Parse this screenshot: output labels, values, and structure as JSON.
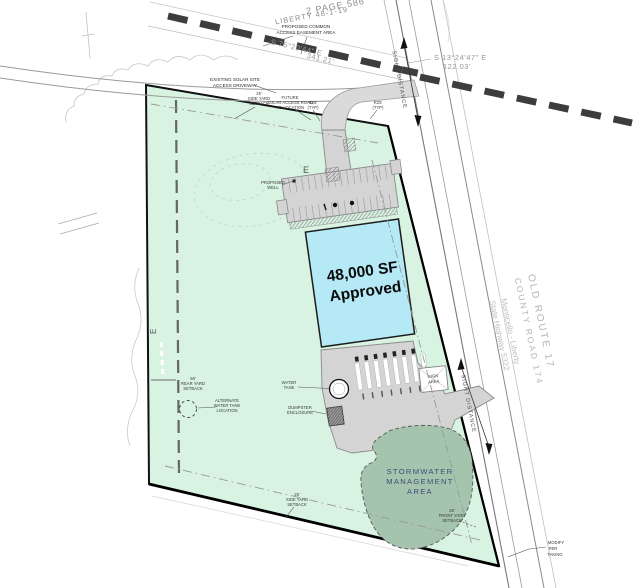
{
  "annotations": {
    "deed": "2 PAGE 586",
    "parcel_ref": "LIBERTY 48-1-19",
    "easement_l1": "PROPOSED COMMON",
    "easement_l2": "ACCESS EASEMENT AREA",
    "bearing1": "S 75°20'44\" E",
    "bearing1_len": "341.21'",
    "bearing2": "S 13°24'47\" E",
    "bearing2_len": "122.03'",
    "existing_l1": "EXISTING SOLAR SITE",
    "existing_l2": "ACCESS DRIVEWAY",
    "setback25": "25'",
    "side_yard": "SIDE YARD",
    "setback_word": "SETBACK",
    "front_yard": "FRONT YARD",
    "future_l1": "FUTURE",
    "future_l2": "SOLAR ACCESS ROAD",
    "future_l3": "RE-LOCATION",
    "r25_l1": "R25'",
    "r25_l2": "(TYP)",
    "well_l1": "PROPOSED",
    "well_l2": "WELL",
    "rear_l1": "50'",
    "rear_l2": "REAR YARD",
    "alt_l1": "ALTERNATE",
    "alt_l2": "WATER TANK",
    "alt_l3": "LOCATION",
    "wt_l1": "WATER",
    "wt_l2": "TANK",
    "dump_l1": "DUMPSTER",
    "dump_l2": "ENCLOSURE",
    "sign_l1": "SIGN",
    "sign_l2": "AREA",
    "taking_l1": "MODIFY",
    "taking_l2": "PER",
    "taking_l3": "TAKING",
    "e_marker": "E"
  },
  "building": {
    "area": "48,000 SF",
    "status": "Approved"
  },
  "stormwater": {
    "l1": "STORMWATER",
    "l2": "MANAGEMENT",
    "l3": "AREA"
  },
  "road": {
    "sight_distance": "SIGHT DISTANCE",
    "name1": "OLD ROUTE 17",
    "name2": "COUNTY ROAD 174",
    "name3": "Monticello - Liberty",
    "name4": "State Highway 5322"
  },
  "colors": {
    "parcel": "#d8f3e2",
    "building": "#b4e9f5",
    "stormwater": "#a5c4ae",
    "pavement": "#d4d4d4",
    "road_dash": "#3d3d3d"
  }
}
